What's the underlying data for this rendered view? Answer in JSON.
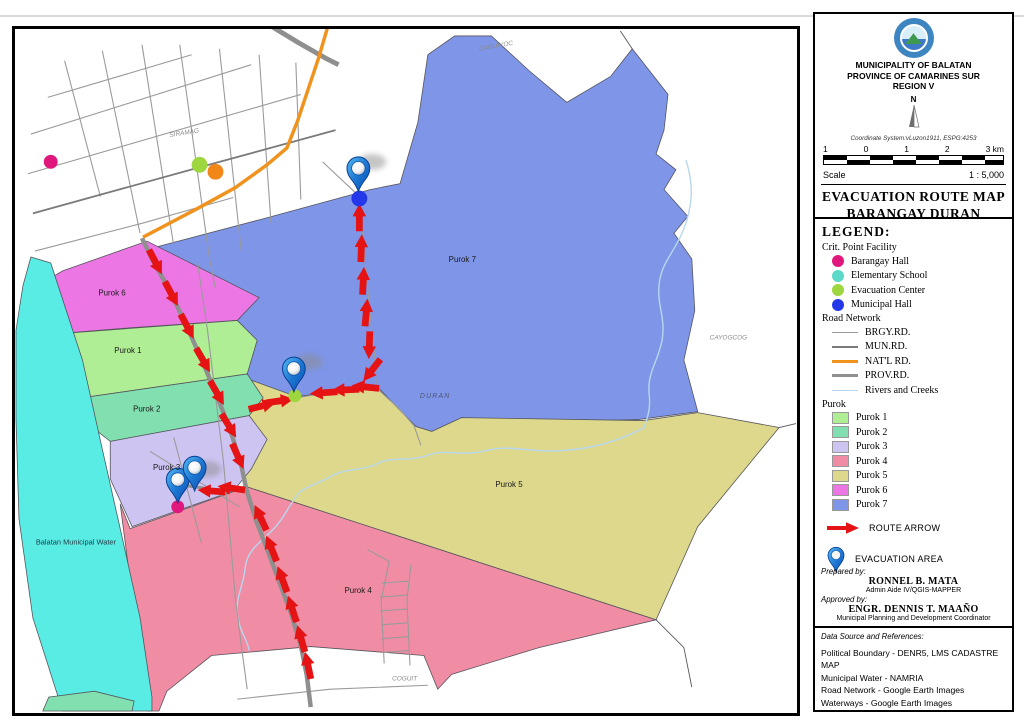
{
  "header": {
    "municipality": "MUNICIPALITY OF BALATAN",
    "province": "PROVINCE OF CAMARINES SUR",
    "region": "REGION V",
    "compass_label": "N",
    "coordinate_system": "Coordinate System:vLuzon1911, ESPG:4253",
    "scale_ticks": [
      "1",
      "0",
      "1",
      "2",
      "3 km"
    ],
    "scale_label": "Scale",
    "scale_ratio": "1 : 5,000",
    "title_line1": "EVACUATION ROUTE MAP",
    "title_line2": "BARANGAY DURAN"
  },
  "legend": {
    "heading": "LEGEND:",
    "facility_heading": "Crit. Point Facility",
    "facilities": [
      {
        "label": "Barangay Hall"
      },
      {
        "label": "Elementary School"
      },
      {
        "label": "Evacuation Center"
      },
      {
        "label": "Municipal Hall"
      }
    ],
    "road_heading": "Road Network",
    "roads": [
      {
        "label": "BRGY.RD."
      },
      {
        "label": "MUN.RD."
      },
      {
        "label": "NAT'L RD."
      },
      {
        "label": "PROV.RD."
      },
      {
        "label": "Rivers and Creeks"
      }
    ],
    "purok_heading": "Purok",
    "puroks": [
      {
        "label": "Purok 1"
      },
      {
        "label": "Purok 2"
      },
      {
        "label": "Purok 3"
      },
      {
        "label": "Purok 4"
      },
      {
        "label": "Purok 5"
      },
      {
        "label": "Purok 6"
      },
      {
        "label": "Purok 7"
      }
    ],
    "route_arrow_label": "ROUTE ARROW",
    "evacuation_area_label": "EVACUATION AREA"
  },
  "credits": {
    "prepared_label": "Prepared by:",
    "prepared_name": "RONNEL B. MATA",
    "prepared_role": "Admin Aide IV/QGIS-MAPPER",
    "approved_label": "Approved by:",
    "approved_name": "ENGR. DENNIS T. MAAÑO",
    "approved_role": "Municipal Planning and Development Coordinator"
  },
  "data_source": {
    "heading": "Data Source and References:",
    "lines": [
      "Political Boundary - DENR5, LMS CADASTRE MAP",
      "Municipal Water - NAMRIA",
      "Road Network - Google Earth Images",
      "Waterways - Google Earth Images"
    ]
  },
  "map": {
    "labels": {
      "purok1": "Purok 1",
      "purok2": "Purok 2",
      "purok3": "Purok 3",
      "purok4": "Purok 4",
      "purok5": "Purok 5",
      "purok6": "Purok 6",
      "purok7": "Purok 7",
      "water": "Balatan Municipal Water",
      "siramag": "SIRAMAG",
      "caguiyoc": "CAGUIYOC",
      "cayogcog": "CAYOGCOG",
      "duran": "DURAN",
      "coguit": "COGUIT"
    }
  },
  "colors": {
    "purok1": "#b0ee95",
    "purok2": "#82dfb0",
    "purok3": "#cdc4f2",
    "purok4": "#f08da4",
    "purok5": "#ddd88c",
    "purok6": "#ec77e4",
    "purok7": "#7e95e8",
    "water": "#58ece4",
    "route": "#e51313",
    "natl": "#f0921e",
    "prov": "#8f8f8f",
    "brgy": "#9a9a9a",
    "mun": "#7a7a7a",
    "river": "#b8d7ee",
    "fac_brgyhall": "#e0187d",
    "fac_school": "#5ad9c9",
    "fac_evac": "#9ed63f",
    "fac_munhall": "#2438ea",
    "fac_other": "#f28718",
    "pin": "#1d78d2"
  }
}
